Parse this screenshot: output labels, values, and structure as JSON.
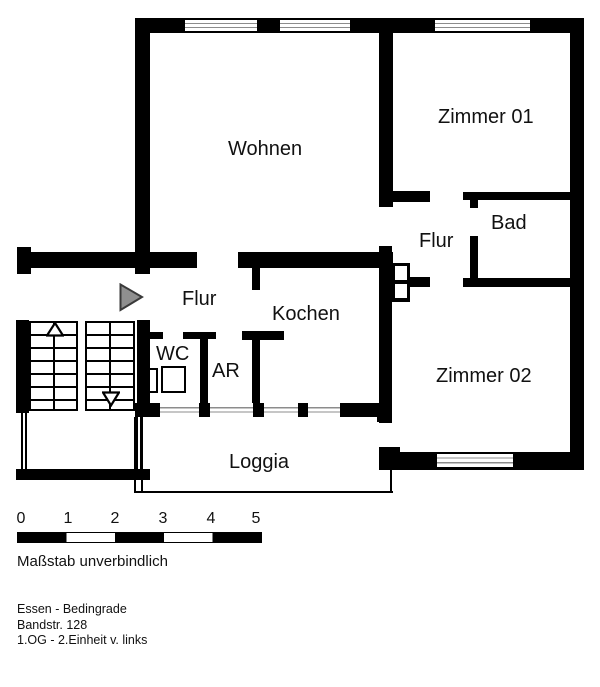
{
  "title": "Grundriss",
  "rooms": {
    "wohnen": "Wohnen",
    "zimmer01": "Zimmer 01",
    "bad": "Bad",
    "flur_right": "Flur",
    "flur_left": "Flur",
    "kochen": "Kochen",
    "wc": "WC",
    "ar": "AR",
    "zimmer02": "Zimmer 02",
    "loggia": "Loggia"
  },
  "scale": {
    "labels": [
      "0",
      "1",
      "2",
      "3",
      "4",
      "5"
    ],
    "caption": "Maßstab unverbindlich"
  },
  "address": {
    "line1": "Essen - Bedingrade",
    "line2": "Bandstr. 128",
    "line3": "1.OG - 2.Einheit v. links"
  },
  "colors": {
    "wall": "#000000",
    "window_line": "#8c8c8c",
    "entrance_arrow_fill": "#8f8f8f",
    "background": "#ffffff"
  }
}
